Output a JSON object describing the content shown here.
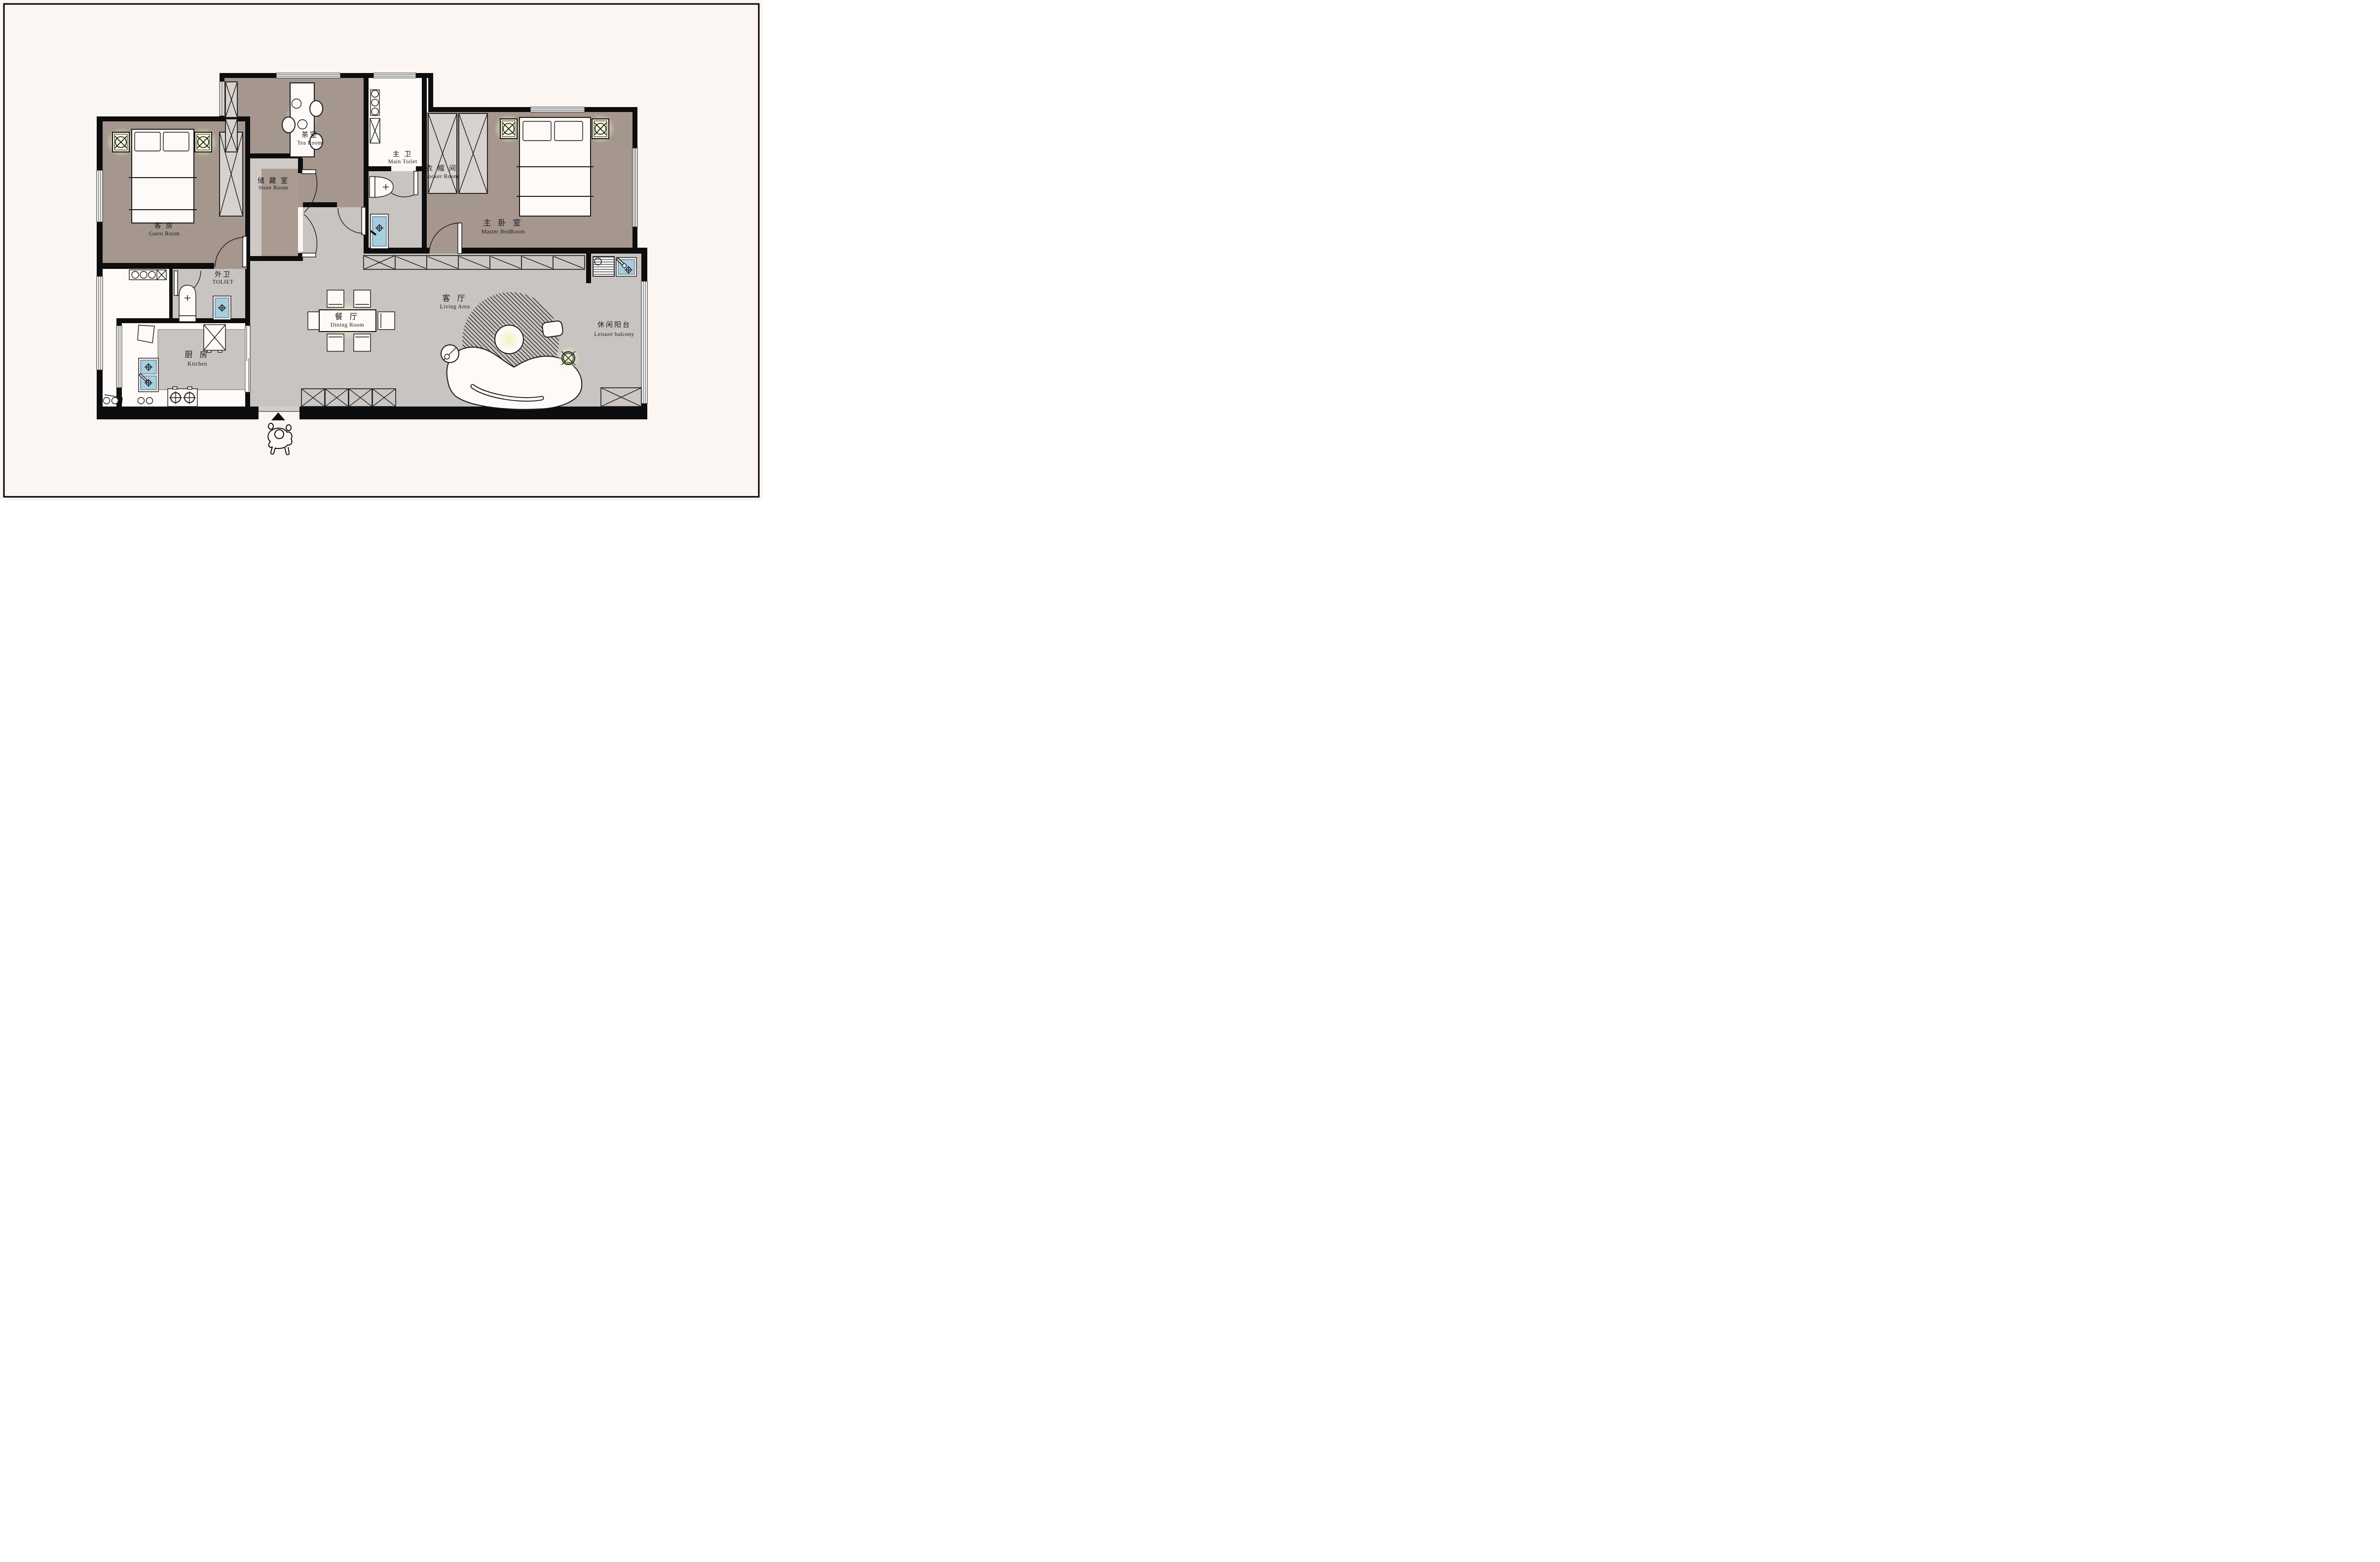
{
  "plan": {
    "rooms": [
      {
        "id": "guest-room",
        "zh": "客 房",
        "en": "Guest Room"
      },
      {
        "id": "tea-room",
        "zh": "茶室",
        "en": "Tea Room"
      },
      {
        "id": "store-room",
        "zh": "储 藏 室",
        "en": "Store Room"
      },
      {
        "id": "main-toilet",
        "zh": "主 卫",
        "en": "Main Toilet"
      },
      {
        "id": "locker-room",
        "zh": "衣 帽 间",
        "en": "Locker Room"
      },
      {
        "id": "master-bedroom",
        "zh": "主 卧 室",
        "en": "Master BedRoom"
      },
      {
        "id": "outer-toilet",
        "zh": "外卫",
        "en": "TOLIET"
      },
      {
        "id": "dining-room",
        "zh": "餐 厅",
        "en": "Dining Room"
      },
      {
        "id": "living-area",
        "zh": "客 厅",
        "en": "Living Area"
      },
      {
        "id": "kitchen",
        "zh": "厨 房",
        "en": "Kitchen"
      },
      {
        "id": "leisure-balcony",
        "zh": "休闲阳台",
        "en": "Leisure balcony"
      }
    ],
    "colors": {
      "wall": "#0d0d0d",
      "warm_room_floor": "#a5968e",
      "gray_floor": "#c8c4c1",
      "light_floor": "#cfcac6",
      "white_floor": "#fdfaf7",
      "sink_blue": "#a9cde0",
      "lamp_glow": "#edf4c2",
      "paper": "#fbf6f2"
    }
  }
}
